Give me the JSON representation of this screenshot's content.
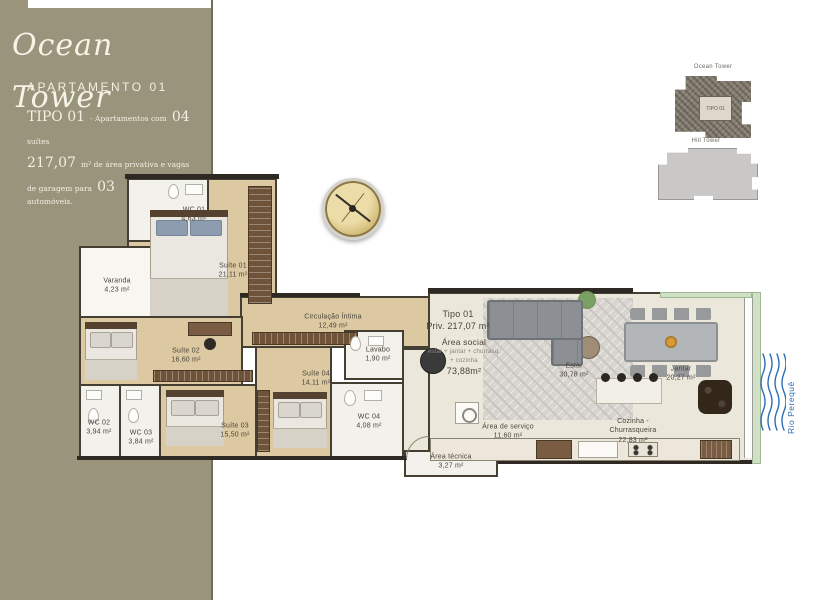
{
  "brand": {
    "logo_script": "Ocean Tower",
    "apartment_title": "APARTAMENTO 01",
    "spec": {
      "tipo_big": "TIPO 01",
      "tipo_small": "- Apartamentos com",
      "suites_big": "04",
      "suites_small": "suítes",
      "area_big": "217,07",
      "area_small": "m² de área privativa e vagas de garagem para",
      "cars_big": "03",
      "cars_small": "automóveis."
    }
  },
  "rooms": {
    "wc01": {
      "name": "WC 01",
      "area": "4,63 m²"
    },
    "suite01": {
      "name": "Suíte 01",
      "area": "21,11 m²"
    },
    "varanda": {
      "name": "Varanda",
      "area": "4,23 m²"
    },
    "suite02": {
      "name": "Suíte 02",
      "area": "16,60 m²"
    },
    "wc02": {
      "name": "WC 02",
      "area": "3,94 m²"
    },
    "wc03": {
      "name": "WC 03",
      "area": "3,84 m²"
    },
    "suite03": {
      "name": "Suíte 03",
      "area": "15,50 m²"
    },
    "suite04": {
      "name": "Suíte 04",
      "area": "14,11 m²"
    },
    "circulacao": {
      "name": "Circulação Íntima",
      "area": "12,49 m²"
    },
    "lavabo": {
      "name": "Lavabo",
      "area": "1,90 m²"
    },
    "wc04": {
      "name": "WC 04",
      "area": "4,08 m²"
    },
    "estar": {
      "name": "Estar",
      "area": "30,78 m²"
    },
    "jantar": {
      "name": "Jantar",
      "area": "20,27 m²"
    },
    "cozinha": {
      "name": "Cozinha -",
      "name2": "Churrasqueira",
      "area": "22,83 m²"
    },
    "servico": {
      "name": "Área de serviço",
      "area": "11,60 m²"
    },
    "tecnica": {
      "name": "Área técnica",
      "area": "3,27 m²"
    }
  },
  "summary": {
    "tipo": "Tipo 01",
    "priv": "Priv. 217,07 m²",
    "social_title": "Área social",
    "social_sub1": "estar + jantar + churrasq.",
    "social_sub2": "+ cozinha",
    "social_area": "73,88m²"
  },
  "keyplans": {
    "ocean_label": "Ocean Tower",
    "hill_label": "Hill Tower",
    "unit_label": "TIPO 01"
  },
  "river_label": "Rio Perequê",
  "colors": {
    "band": "#9a947d",
    "wood_floor": "#dcc9a2",
    "wall": "#2e2922",
    "river_blue": "#2e6db4",
    "planter_green": "#cfe0c4"
  }
}
